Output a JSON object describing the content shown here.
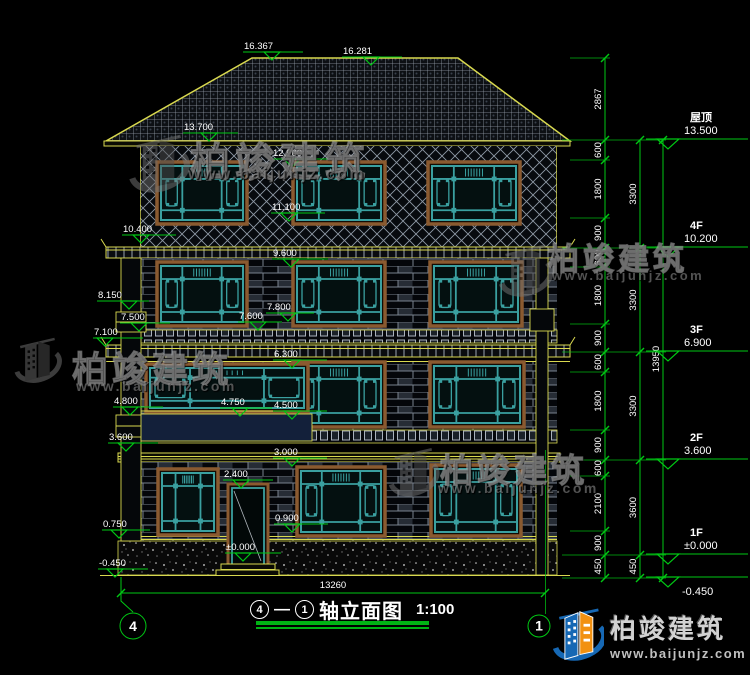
{
  "drawing_title": {
    "axis_left": "4",
    "axis_separator": "—",
    "axis_right": "1",
    "text": "轴立面图",
    "scale": "1:100"
  },
  "axis_bubbles": {
    "left": "4",
    "right": "1"
  },
  "bottom_dimension": "13260",
  "colors": {
    "dim_green": "#00c814",
    "outline_yellow": "#d9d94f",
    "window_teal": "#3aa0a0",
    "text_white": "#ffffff",
    "brand_blue": "#1668b4",
    "brand_orange": "#f29111"
  },
  "elevation_markers": [
    {
      "label": "16.367",
      "x": 243,
      "y": 52,
      "w": 60,
      "tx": 272
    },
    {
      "label": "16.281",
      "x": 342,
      "y": 57,
      "w": 60,
      "tx": 371
    },
    {
      "label": "13.700",
      "x": 183,
      "y": 133,
      "w": 55,
      "tx": 209
    },
    {
      "label": "12.900",
      "x": 272,
      "y": 159,
      "w": 56,
      "tx": 292
    },
    {
      "label": "11.100",
      "x": 271,
      "y": 213,
      "w": 54,
      "tx": 289
    },
    {
      "label": "10.400",
      "x": 122,
      "y": 235,
      "w": 54,
      "tx": 141
    },
    {
      "label": "9.600",
      "x": 272,
      "y": 259,
      "w": 56,
      "tx": 291
    },
    {
      "label": "8.150",
      "x": 97,
      "y": 301,
      "w": 52,
      "tx": 129
    },
    {
      "label": "7.800",
      "x": 266,
      "y": 313,
      "w": 48,
      "tx": 288
    },
    {
      "label": "7.600",
      "x": 238,
      "y": 322,
      "w": 44,
      "tx": 258
    },
    {
      "label": "7.500",
      "x": 120,
      "y": 323,
      "w": 50,
      "tx": 139
    },
    {
      "label": "7.100",
      "x": 93,
      "y": 338,
      "w": 50,
      "tx": 105
    },
    {
      "label": "6.300",
      "x": 273,
      "y": 360,
      "w": 54,
      "tx": 292
    },
    {
      "label": "4.800",
      "x": 113,
      "y": 407,
      "w": 50,
      "tx": 130
    },
    {
      "label": "4.750",
      "x": 220,
      "y": 408,
      "w": 52,
      "tx": 240
    },
    {
      "label": "4.500",
      "x": 273,
      "y": 411,
      "w": 54,
      "tx": 292
    },
    {
      "label": "3.600",
      "x": 108,
      "y": 443,
      "w": 50,
      "tx": 126
    },
    {
      "label": "3.000",
      "x": 273,
      "y": 458,
      "w": 54,
      "tx": 292
    },
    {
      "label": "2.400",
      "x": 223,
      "y": 480,
      "w": 50,
      "tx": 241
    },
    {
      "label": "0.900",
      "x": 274,
      "y": 524,
      "w": 54,
      "tx": 292
    },
    {
      "label": "0.750",
      "x": 102,
      "y": 530,
      "w": 48,
      "tx": 119
    },
    {
      "label": "±0.000",
      "x": 225,
      "y": 553,
      "w": 56,
      "tx": 243
    },
    {
      "label": "-0.450",
      "x": 98,
      "y": 569,
      "w": 50,
      "tx": 115
    }
  ],
  "right_dims": {
    "col1": {
      "x": 605,
      "ticks": [
        58,
        140,
        160,
        218,
        248,
        267,
        324,
        352,
        372,
        430,
        460,
        476,
        531,
        555,
        578
      ],
      "labels": [
        "2867",
        "600",
        "1800",
        "900",
        "600",
        "1800",
        "900",
        "600",
        "1800",
        "900",
        "600",
        "2100",
        "900",
        "450"
      ]
    },
    "col2": {
      "x": 640,
      "ticks": [
        140,
        248,
        352,
        460,
        555,
        578
      ],
      "labels": [
        "3300",
        "3300",
        "3300",
        "3600",
        "450"
      ]
    },
    "col3": {
      "x": 663,
      "ticks": [
        140,
        578
      ],
      "labels": [
        "13950"
      ]
    }
  },
  "floor_levels": [
    {
      "label": "屋顶",
      "elev": "13.500",
      "y": 140
    },
    {
      "label": "4F",
      "elev": "10.200",
      "y": 248
    },
    {
      "label": "3F",
      "elev": "6.900",
      "y": 352
    },
    {
      "label": "2F",
      "elev": "3.600",
      "y": 460
    },
    {
      "label": "1F",
      "elev": "±0.000",
      "y": 555
    },
    {
      "label": "",
      "elev": "-0.450",
      "y": 578,
      "text_below": true
    }
  ],
  "watermark": {
    "text": "柏竣建筑",
    "url": "www.baijunjz.com"
  },
  "logo": {
    "name": "柏竣建筑",
    "url": "www.baijunjz.com"
  }
}
